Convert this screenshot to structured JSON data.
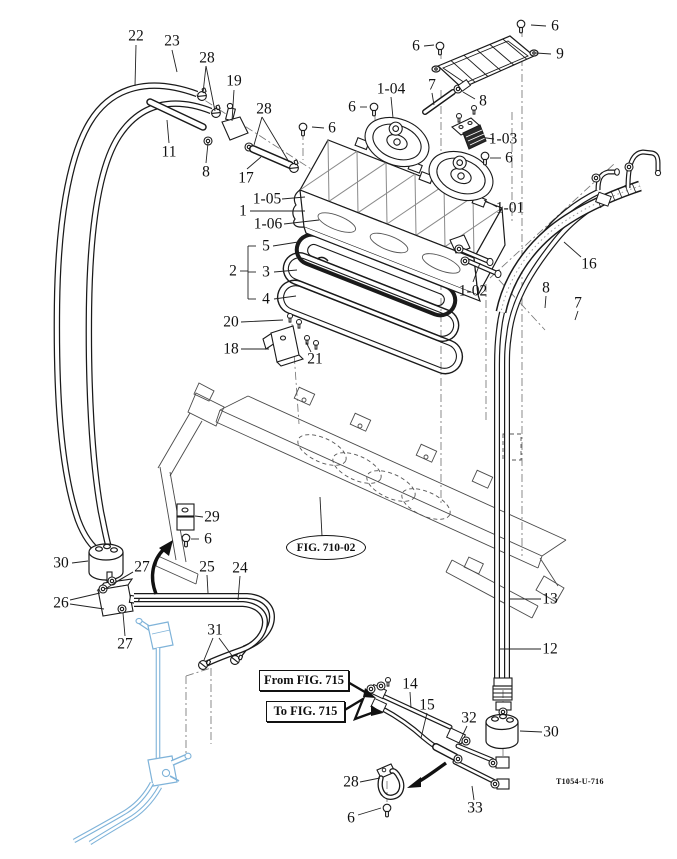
{
  "figure": {
    "fig_ref_bubble": "FIG. 710-02",
    "from_box": "From FIG. 715",
    "to_box": "To FIG. 715",
    "drawing_code": "T1054-U-716",
    "line_color": "#1a1a1a",
    "chassis_color": "#4a4a4a",
    "highlight_color": "#7fb3d9"
  },
  "callouts": [
    {
      "label": "22"
    },
    {
      "label": "23"
    },
    {
      "label": "28"
    },
    {
      "label": "19"
    },
    {
      "label": "28"
    },
    {
      "label": "11"
    },
    {
      "label": "8"
    },
    {
      "label": "17"
    },
    {
      "label": "6"
    },
    {
      "label": "6"
    },
    {
      "label": "9"
    },
    {
      "label": "7"
    },
    {
      "label": "8"
    },
    {
      "label": "1-04"
    },
    {
      "label": "6"
    },
    {
      "label": "6"
    },
    {
      "label": "1-03"
    },
    {
      "label": "6"
    },
    {
      "label": "1-05"
    },
    {
      "label": "1"
    },
    {
      "label": "1-06"
    },
    {
      "label": "1-01"
    },
    {
      "label": "16"
    },
    {
      "label": "5"
    },
    {
      "label": "2"
    },
    {
      "label": "3"
    },
    {
      "label": "4"
    },
    {
      "label": "1-02"
    },
    {
      "label": "8"
    },
    {
      "label": "7"
    },
    {
      "label": "20"
    },
    {
      "label": "18"
    },
    {
      "label": "21"
    },
    {
      "label": "29"
    },
    {
      "label": "6"
    },
    {
      "label": "30"
    },
    {
      "label": "27"
    },
    {
      "label": "25"
    },
    {
      "label": "24"
    },
    {
      "label": "26"
    },
    {
      "label": "31"
    },
    {
      "label": "27"
    },
    {
      "label": "13"
    },
    {
      "label": "12"
    },
    {
      "label": "14"
    },
    {
      "label": "15"
    },
    {
      "label": "32"
    },
    {
      "label": "30"
    },
    {
      "label": "28"
    },
    {
      "label": "33"
    },
    {
      "label": "6"
    }
  ]
}
